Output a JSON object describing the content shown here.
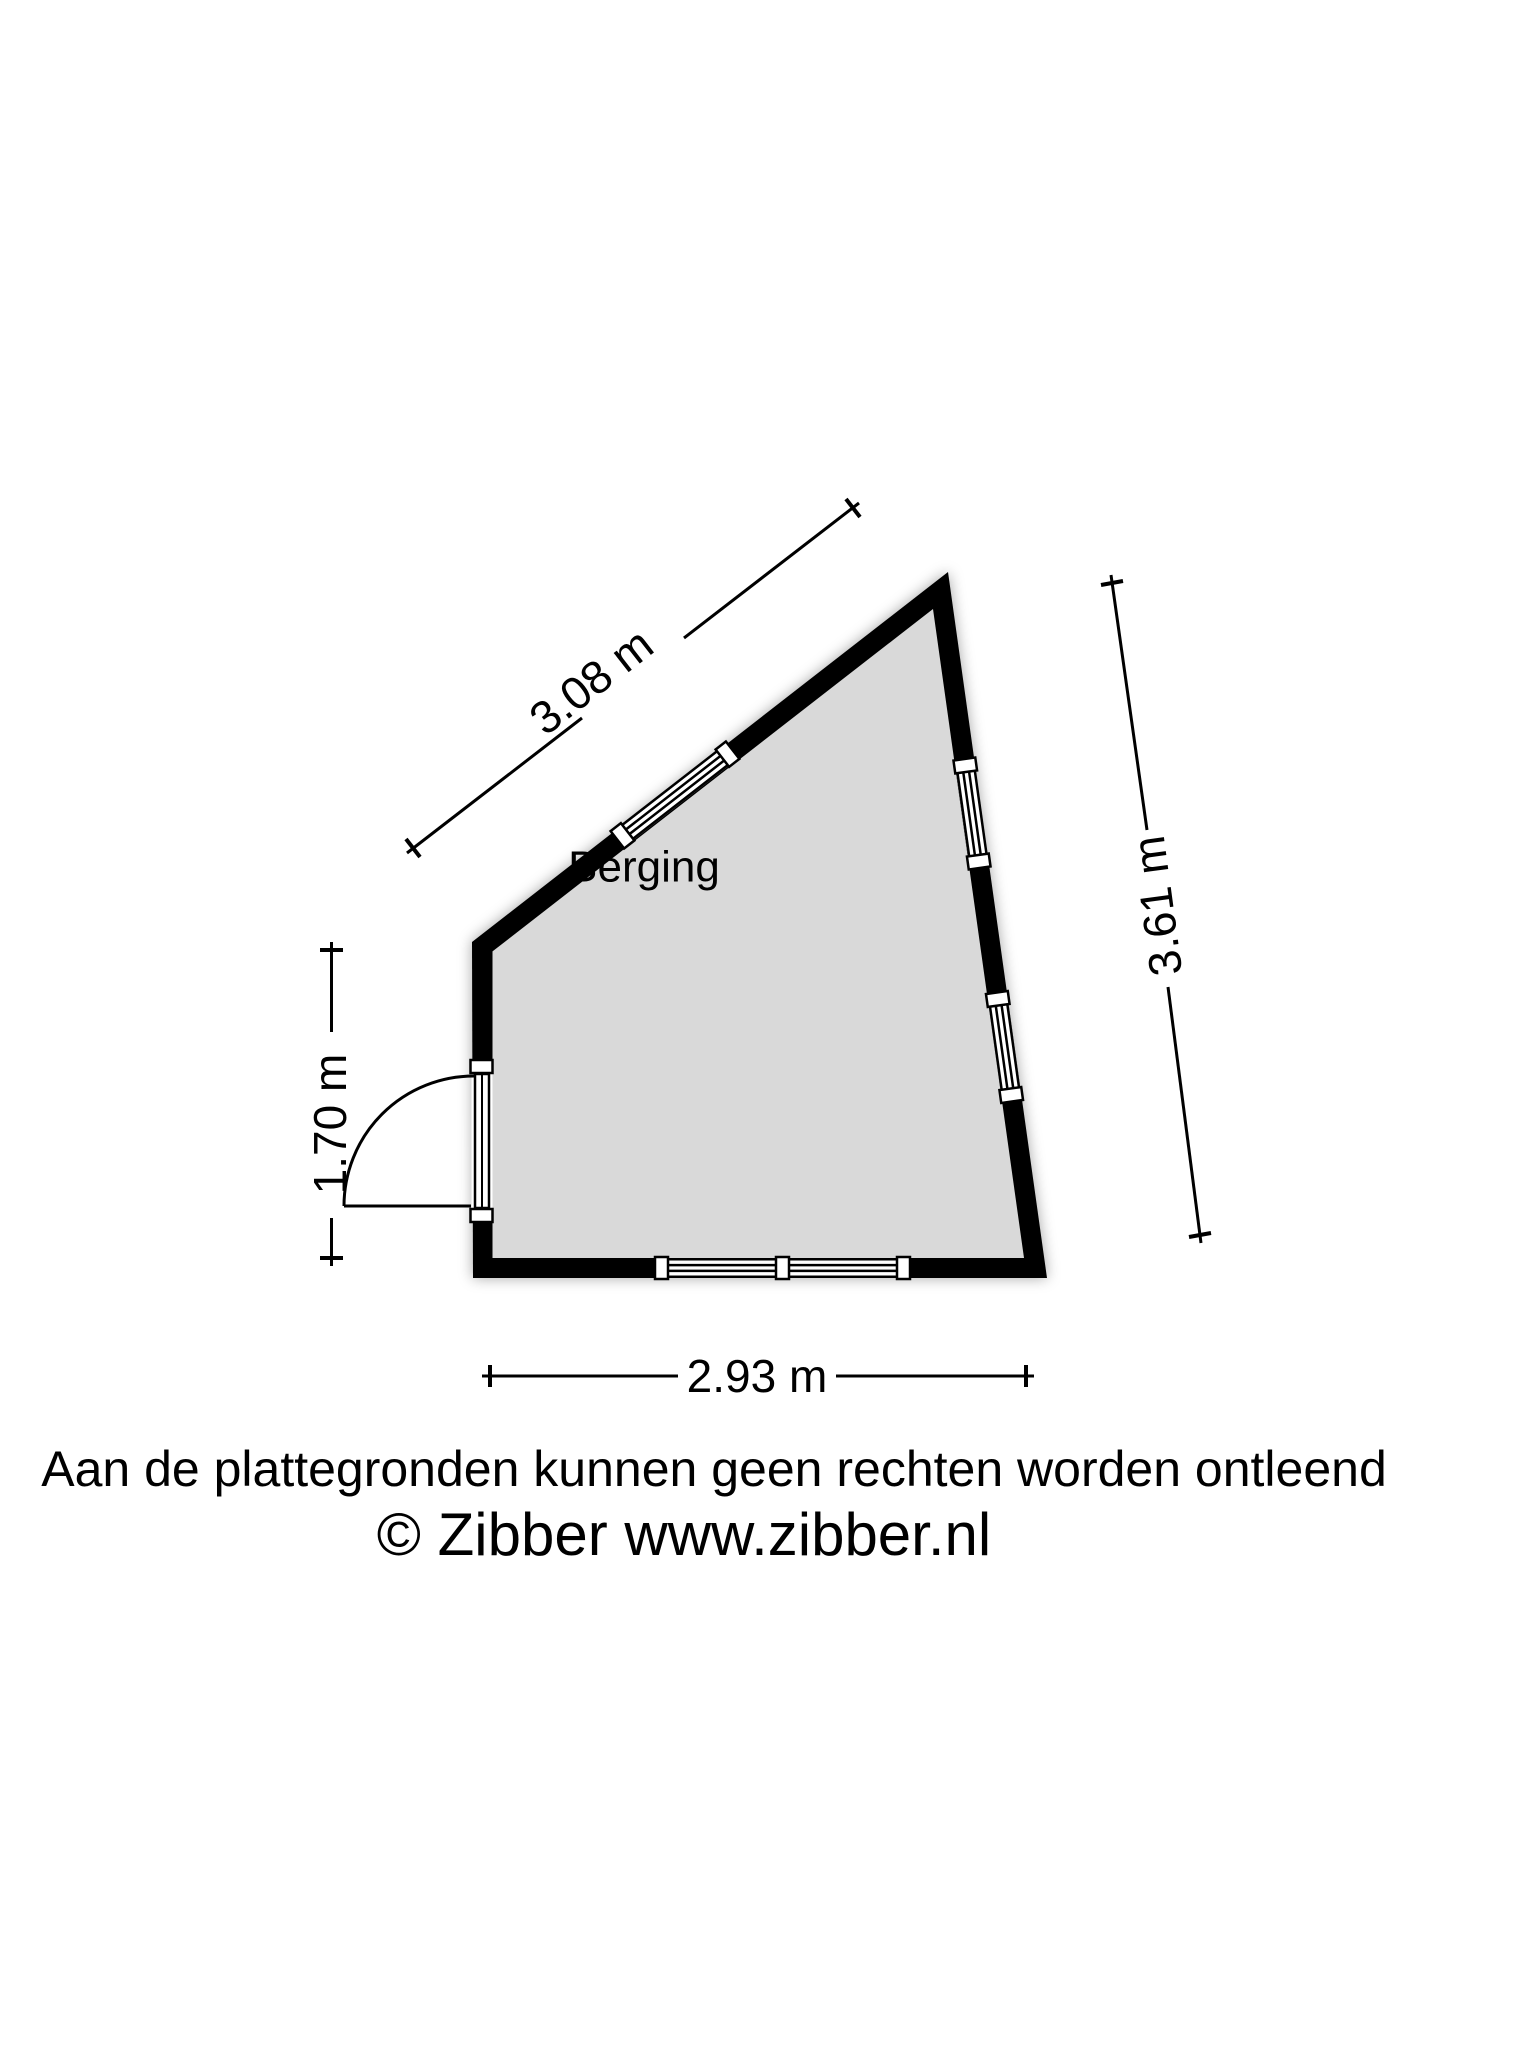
{
  "floorplan": {
    "room_label": "Berging",
    "dimensions": {
      "top": "3.08 m",
      "right": "3.61 m",
      "left": "1.70 m",
      "bottom": "2.93 m"
    },
    "footer": {
      "disclaimer": "Aan de plattegronden kunnen geen rechten worden ontleend",
      "copyright": "© Zibber www.zibber.nl"
    },
    "colors": {
      "wall": "#000000",
      "floor": "#d9d9d9",
      "background": "#ffffff",
      "text": "#000000"
    }
  }
}
